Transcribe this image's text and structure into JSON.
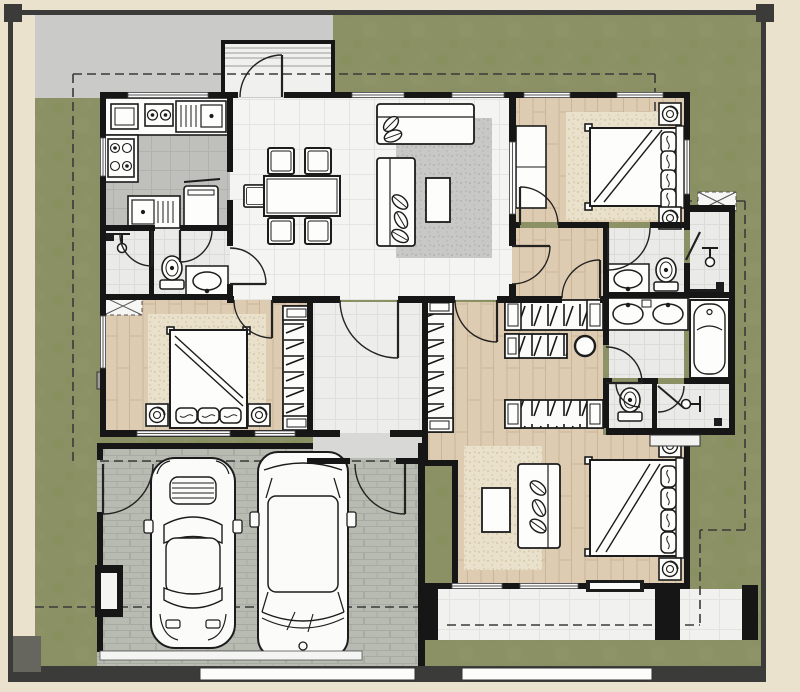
{
  "scene": {
    "kind": "architectural floor plan, top-down view",
    "description": "single-storey house plan with double garage, three bedrooms, three bath zones, kitchen, dining-living great room, walk-in wardrobe, entry porch and rear terrace",
    "text_labels": []
  },
  "colors": {
    "frame": "#EBE2CE",
    "site_wall": "#3B3B39",
    "lawn": "#8B9164",
    "driveway": "#CACBC8",
    "garage_paving": "#B7BBB1",
    "interior_wall": "#161616",
    "wood_floor": "#DECCB2",
    "white_tile": "#F4F4F2",
    "hall_tile": "#EDEDEB",
    "bath_tile": "#EAEAE8",
    "kitchen_tile": "#BFBFBC",
    "terrace_tile": "#F1F1EF",
    "porch": "#F0F0EE",
    "rug_beige": "#E9E1CB",
    "rug_gray": "#C8C8C6",
    "furniture": "#FDFDFB",
    "outline": "#1C1C1C",
    "setback_dash": "#3A3A3A",
    "gate": "#FCFCFA",
    "dark_fixture": "#1c1c1c",
    "window_seat": "#9C9C98",
    "corner_stub": "#66665F"
  },
  "rooms": [
    {
      "name": "driveway",
      "floor": "gray paving"
    },
    {
      "name": "entry-porch",
      "floor": "light tile with steps"
    },
    {
      "name": "kitchen",
      "floor": "gray tile"
    },
    {
      "name": "shower-room-left",
      "floor": "bath tile"
    },
    {
      "name": "wc-left",
      "floor": "bath tile"
    },
    {
      "name": "dining-area",
      "floor": "white tile"
    },
    {
      "name": "living-area",
      "floor": "white tile with gray rug"
    },
    {
      "name": "bedroom-top-right",
      "floor": "wood"
    },
    {
      "name": "bathroom-top-right",
      "floor": "bath tile"
    },
    {
      "name": "shower-top-right",
      "floor": "bath tile"
    },
    {
      "name": "bedroom-middle-left",
      "floor": "wood"
    },
    {
      "name": "hallway",
      "floor": "light tile"
    },
    {
      "name": "walk-in-wardrobe",
      "floor": "wood"
    },
    {
      "name": "master-bathroom",
      "floor": "bath tile"
    },
    {
      "name": "master-wc",
      "floor": "bath tile"
    },
    {
      "name": "master-shower",
      "floor": "bath tile"
    },
    {
      "name": "master-bedroom",
      "floor": "wood"
    },
    {
      "name": "terrace",
      "floor": "white tile"
    },
    {
      "name": "garage",
      "floor": "paver bricks"
    },
    {
      "name": "lawn",
      "floor": "grass"
    }
  ],
  "inventory": {
    "cars": 2,
    "beds": 3,
    "dining_chairs": 5,
    "sofas": 3,
    "coffee_tables": 2,
    "toilets": 3,
    "bathroom_basins": 4,
    "kitchen_sinks": 3,
    "bathtubs": 1,
    "showers": 3,
    "wardrobe_units": 6,
    "potted_plants": 4,
    "washing_machine": 1,
    "stool": 1
  }
}
